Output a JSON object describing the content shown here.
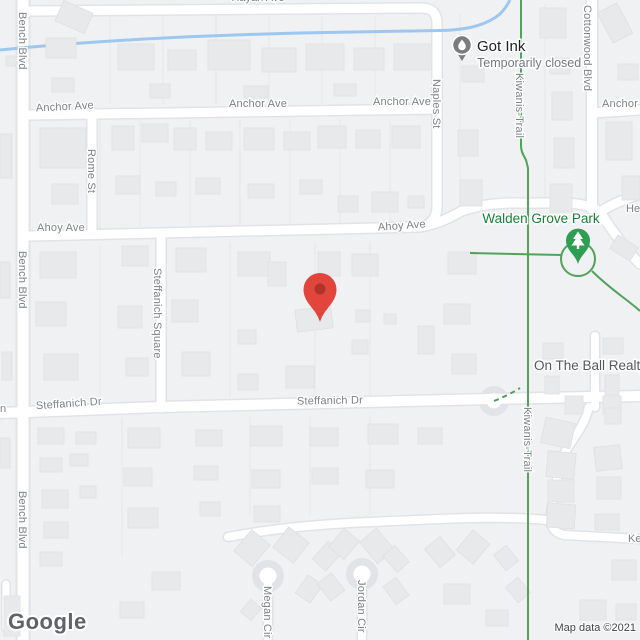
{
  "map": {
    "streets": {
      "bench_blvd": "Bench Blvd",
      "anchor_ave": "Anchor Ave",
      "rome_st": "Rome St",
      "naples_st": "Naples St",
      "ahoy_ave": "Ahoy Ave",
      "kiwanis_trail": "Kiwanis-Trail",
      "cottonwood_blvd": "Cottonwood Blvd",
      "steffanich_square": "Steffanich Square",
      "steffanich_dr": "Steffanich Dr",
      "megan_cir": "Megan Cir",
      "jordan_cir": "Jordan Cir"
    },
    "street_fragments": {
      "right_upper": "He",
      "right_lower": "Ke",
      "left_edge": "n",
      "top_edge": "Hayan Ave"
    },
    "pois": {
      "got_ink": {
        "name": "Got Ink",
        "status": "Temporarily closed",
        "icon": "ink-drop-pin-icon"
      },
      "walden_grove_park": {
        "name": "Walden Grove Park",
        "icon": "tree-pin-icon"
      },
      "on_the_ball_realty": {
        "name": "On The Ball Realty"
      }
    },
    "marker": {
      "type": "red-location-pin",
      "color_body": "#E2453C",
      "color_inner": "#AD332B"
    },
    "attribution": {
      "logo_text": "Google",
      "map_data_text": "Map data ©2021"
    },
    "colors": {
      "land": "#F0F1F3",
      "road_fill": "#FFFFFF",
      "road_casing": "#E1E3E7",
      "building": "#E8E9EB",
      "water_blue": "#9EC7F0",
      "trail_green": "#52A25C",
      "park_label_green": "#188038",
      "street_label_gray": "#7E8287",
      "poi_pin_gray": "#7A7D80"
    }
  }
}
